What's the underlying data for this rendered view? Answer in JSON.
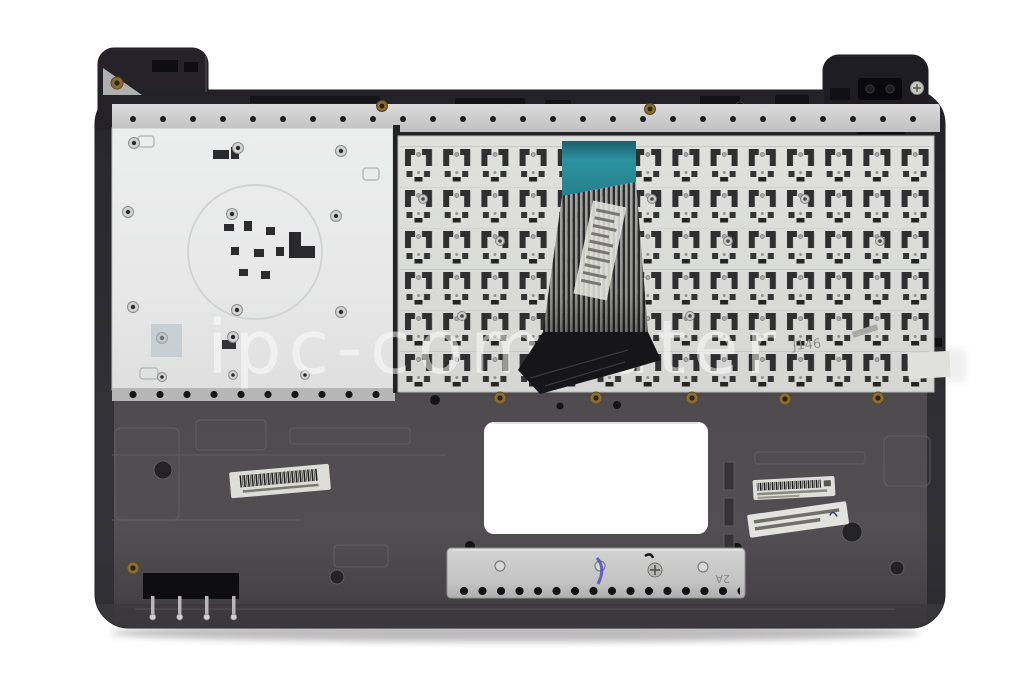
{
  "meta": {
    "subject": "Laptop top case with keyboard assembly, rear (inside) view, product photo on white background"
  },
  "watermark": {
    "text": "ipc-computer",
    "color": "#ffffff",
    "opacity": 0.5
  },
  "markings": {
    "keyboard_stamp": "J146",
    "bracket_stamp": "2A"
  },
  "parts": {
    "left_plate": "aluminum palmrest support plate",
    "keyboard_plate": "keyboard back plate with key mechanisms",
    "ribbon_cable": "keyboard flex ribbon cable with teal stiffener",
    "touchpad_opening": "touchpad cutout (white background visible)",
    "touchpad_bracket": "silver touchpad support bracket",
    "labels": [
      "barcode label bottom-left",
      "barcode label right",
      "part-number label right"
    ]
  },
  "colors": {
    "background": "#ffffff",
    "case_dark": "#29282c",
    "case_light": "#4e4c4e",
    "plate_silver": "#e9eae9",
    "keyboard_plate": "#dbdcda",
    "ribbon_teal": "#2c93a0",
    "bracket_silver": "#c9cac9",
    "pen_mark": "#5b51c8",
    "grommet_gold": "#8a6d33"
  }
}
